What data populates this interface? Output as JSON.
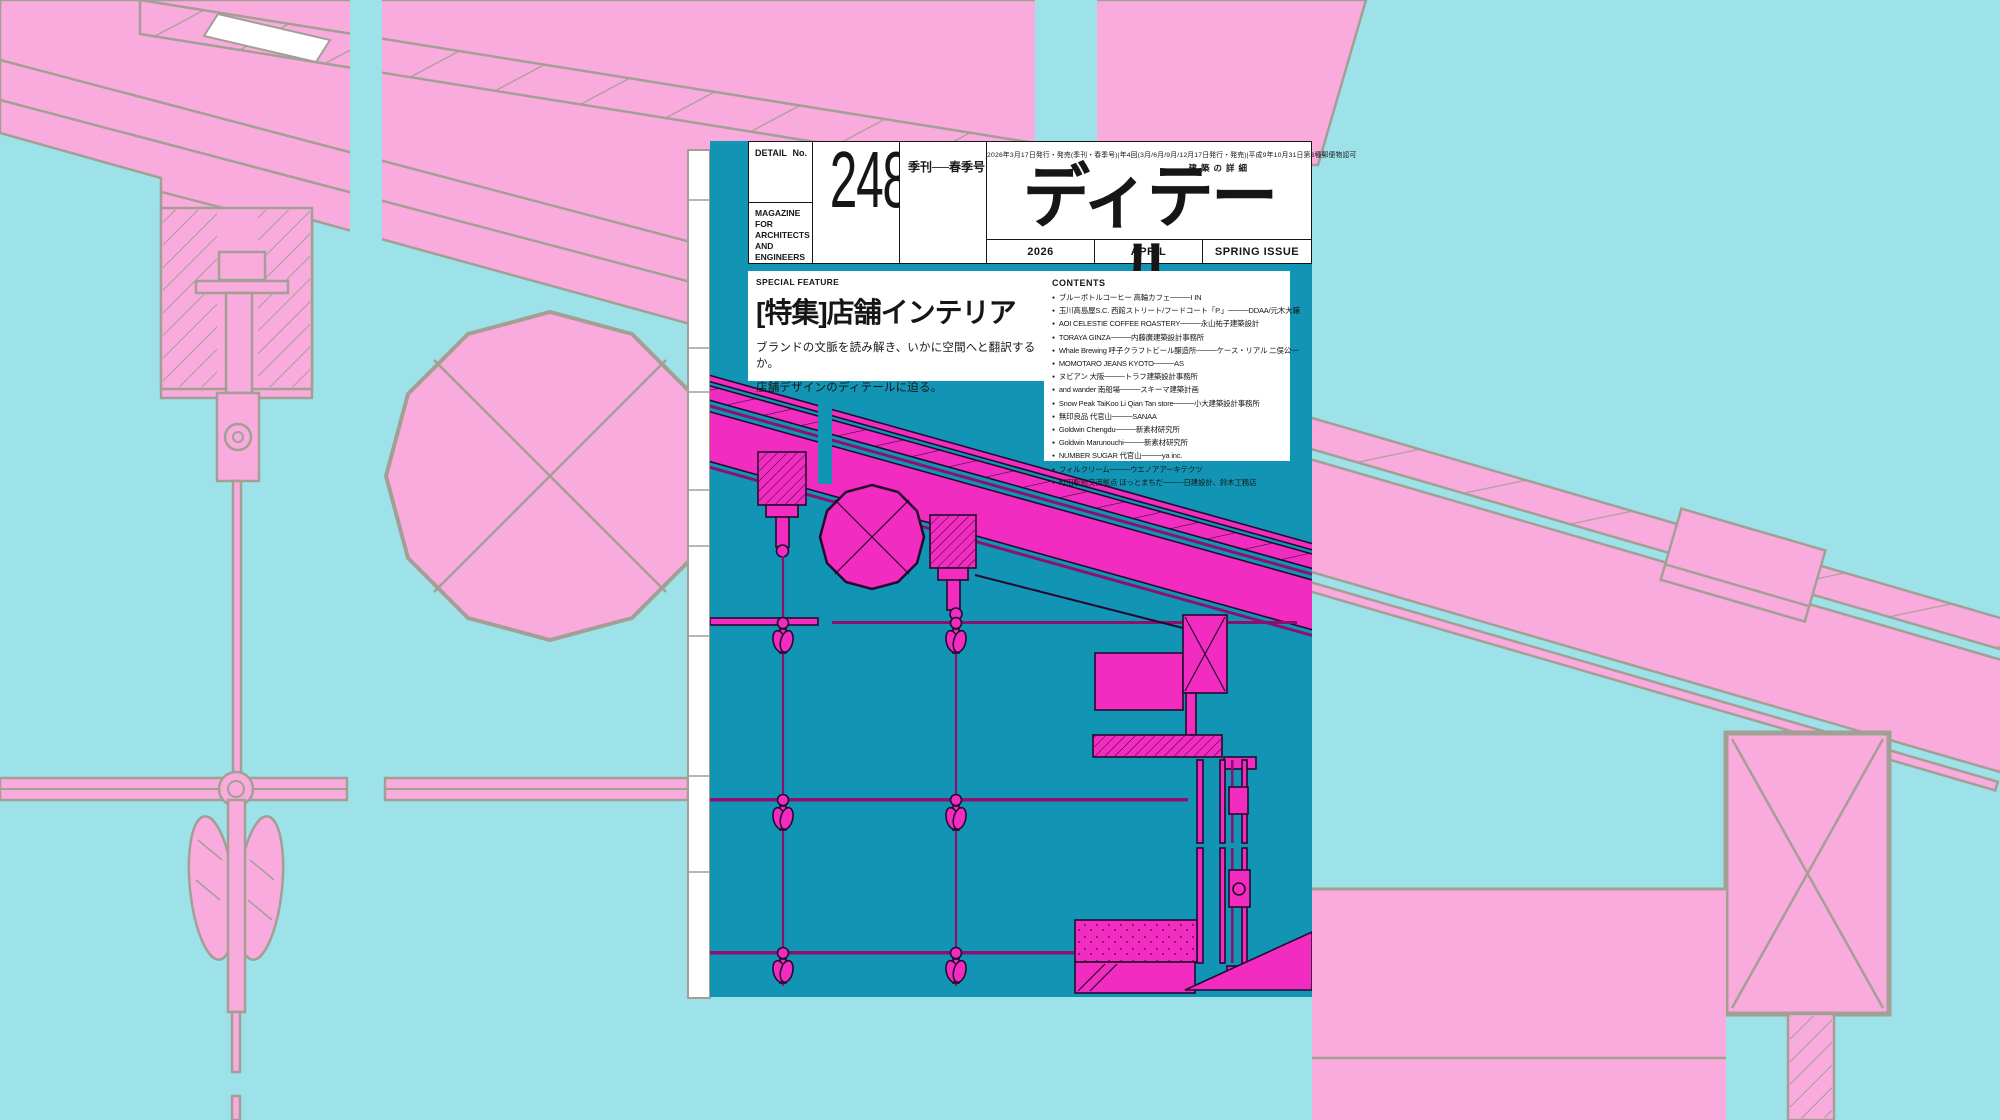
{
  "colors": {
    "bg_cyan": "#9de2e9",
    "bg_pink": "#f9abdd",
    "bg_stroke": "#a39f95",
    "cover_teal": "#1295b5",
    "cover_magenta": "#f22cc0",
    "cover_ink": "#230a2e",
    "cover_line": "#8c1070",
    "text": "#161616"
  },
  "cover": {
    "header": {
      "detail_label": "DETAIL",
      "no_label": "No.",
      "issue_number": "248",
      "season_label": "季刊──春季号",
      "fine_print": "2026年3月17日発行・発売(季刊・春季号)|年4回(3月/6月/9月/12月17日発行・発売)|平成9年10月31日第3種郵便物認可",
      "magazine_for": "MAGAZINE FOR ARCHITECTS AND ENGINEERS",
      "logo": "ディテール",
      "logo_sub": "建築の詳細",
      "year": "2026",
      "month": "APRIL",
      "issue": "SPRING ISSUE"
    },
    "feature": {
      "label": "SPECIAL FEATURE",
      "title": "[特集]店舗インテリア",
      "desc1": "ブランドの文脈を読み解き、いかに空間へと翻訳するか。",
      "desc2": "店舗デザインのディテールに迫る。"
    },
    "contents": {
      "heading": "CONTENTS",
      "bullet": "●",
      "items": [
        "ブルーボトルコーヒー 高輪カフェ────I IN",
        "玉川高島屋S.C. 西館ストリート/フードコート「P.」────DDAA/元木大輔",
        "AOI CELESTIE COFFEE ROASTERY────永山祐子建築設計",
        "TORAYA GINZA────内藤廣建築設計事務所",
        "Whale Brewing 呼子クラフトビール醸造所────ケース・リアル 二俣公一",
        "MOMOTARO JEANS KYOTO────AS",
        "ヌビアン 大阪────トラフ建築設計事務所",
        "and wander 南船場────スキーマ建築計画",
        "Snow Peak TaiKoo Li Qian Tan store────小大建築設計事務所",
        "無印良品 代官山────SANAA",
        "Goldwin Chengdu────新素材研究所",
        "Goldwin Marunouchi────新素材研究所",
        "NUMBER SUGAR 代官山────ya inc.",
        "フィルクリーム────ウエノアアーキテクツ",
        "町田駅前交流拠点 ほっとまちだ────日建設計、鈴木工務店"
      ]
    }
  }
}
